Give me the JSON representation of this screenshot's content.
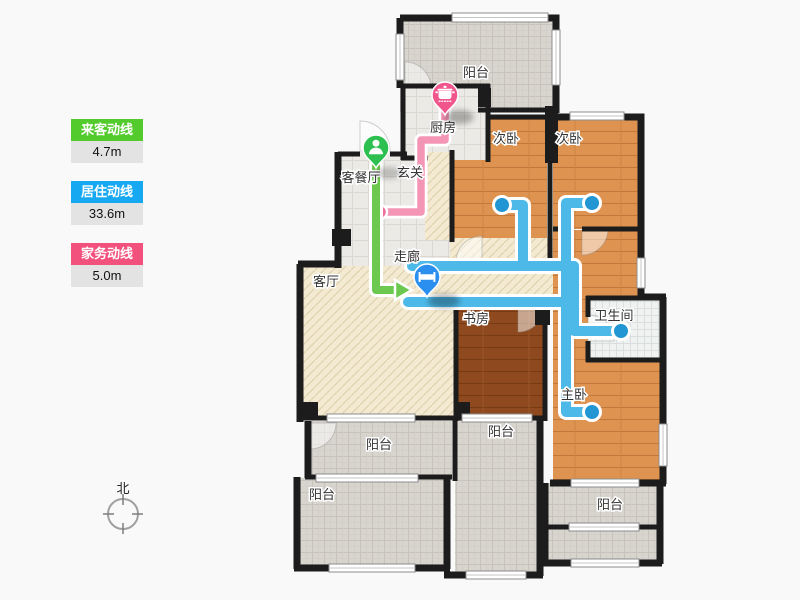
{
  "legend": {
    "items": [
      {
        "label": "来客动线",
        "value": "4.7m",
        "color": "#54cb2d"
      },
      {
        "label": "居住动线",
        "value": "33.6m",
        "color": "#16a9f2"
      },
      {
        "label": "家务动线",
        "value": "5.0m",
        "color": "#f3517d"
      }
    ]
  },
  "compass": {
    "label": "北"
  },
  "rooms": {
    "balcony_top": "阳台",
    "kitchen": "厨房",
    "bedroom_a": "次卧",
    "bedroom_b": "次卧",
    "dining": "客餐厅",
    "entry": "玄关",
    "corridor": "走廊",
    "living": "客厅",
    "study": "书房",
    "bathroom": "卫生间",
    "master": "主卧",
    "balcony_mid": "阳台",
    "balcony_center": "阳台",
    "balcony_bottom_left": "阳台",
    "balcony_bottom_right": "阳台"
  },
  "markers": {
    "guest": {
      "icon": "person-icon",
      "pin_color": "#2dc050"
    },
    "living": {
      "icon": "bed-icon",
      "pin_color": "#2b8ff0"
    },
    "chore": {
      "icon": "cooking-pot-icon",
      "pin_color": "#f0558b"
    }
  },
  "path_colors": {
    "guest": "#6cc84e",
    "living": "#4db9e8",
    "chore": "#f595b6"
  },
  "endpoint_colors": {
    "living_dot": "#2196d3",
    "chore_dot": "#ec6f9c"
  }
}
